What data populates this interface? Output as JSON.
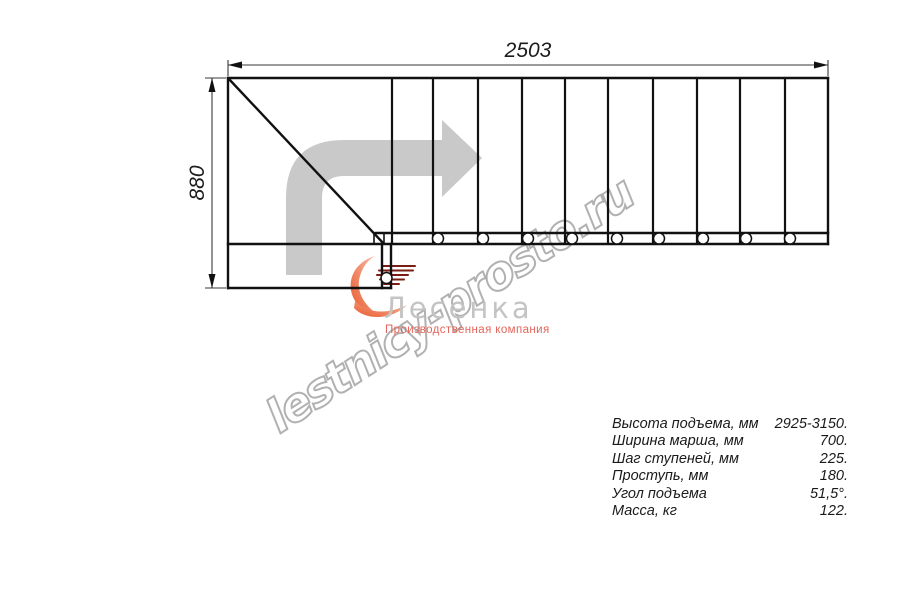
{
  "drawing": {
    "dimensions": {
      "width_mm": "2503",
      "height_mm": "880"
    }
  },
  "watermark": {
    "text": "lestnicy-prosto.ru"
  },
  "logo": {
    "name": "Лесенка",
    "tagline": "Производственная компания"
  },
  "specs": {
    "rows": [
      {
        "label": "Высота подъема, мм",
        "value": "2925-3150."
      },
      {
        "label": "Ширина марша, мм",
        "value": "700."
      },
      {
        "label": "Шаг ступеней, мм",
        "value": "225."
      },
      {
        "label": "Проступь, мм",
        "value": "180."
      },
      {
        "label": "Угол подъема",
        "value": "51,5°."
      },
      {
        "label": "Масса, кг",
        "value": "122."
      }
    ]
  },
  "colors": {
    "line": "#111111",
    "dimension": "#3a3a3a",
    "arrow_gray": "#c9c9c9",
    "watermark_gray": "#9e9e9e",
    "logo_gray": "#c4c4c4",
    "logo_red": "#e2665b",
    "logo_orange": "#e85a2e",
    "logo_salmon": "#f6b39b"
  }
}
